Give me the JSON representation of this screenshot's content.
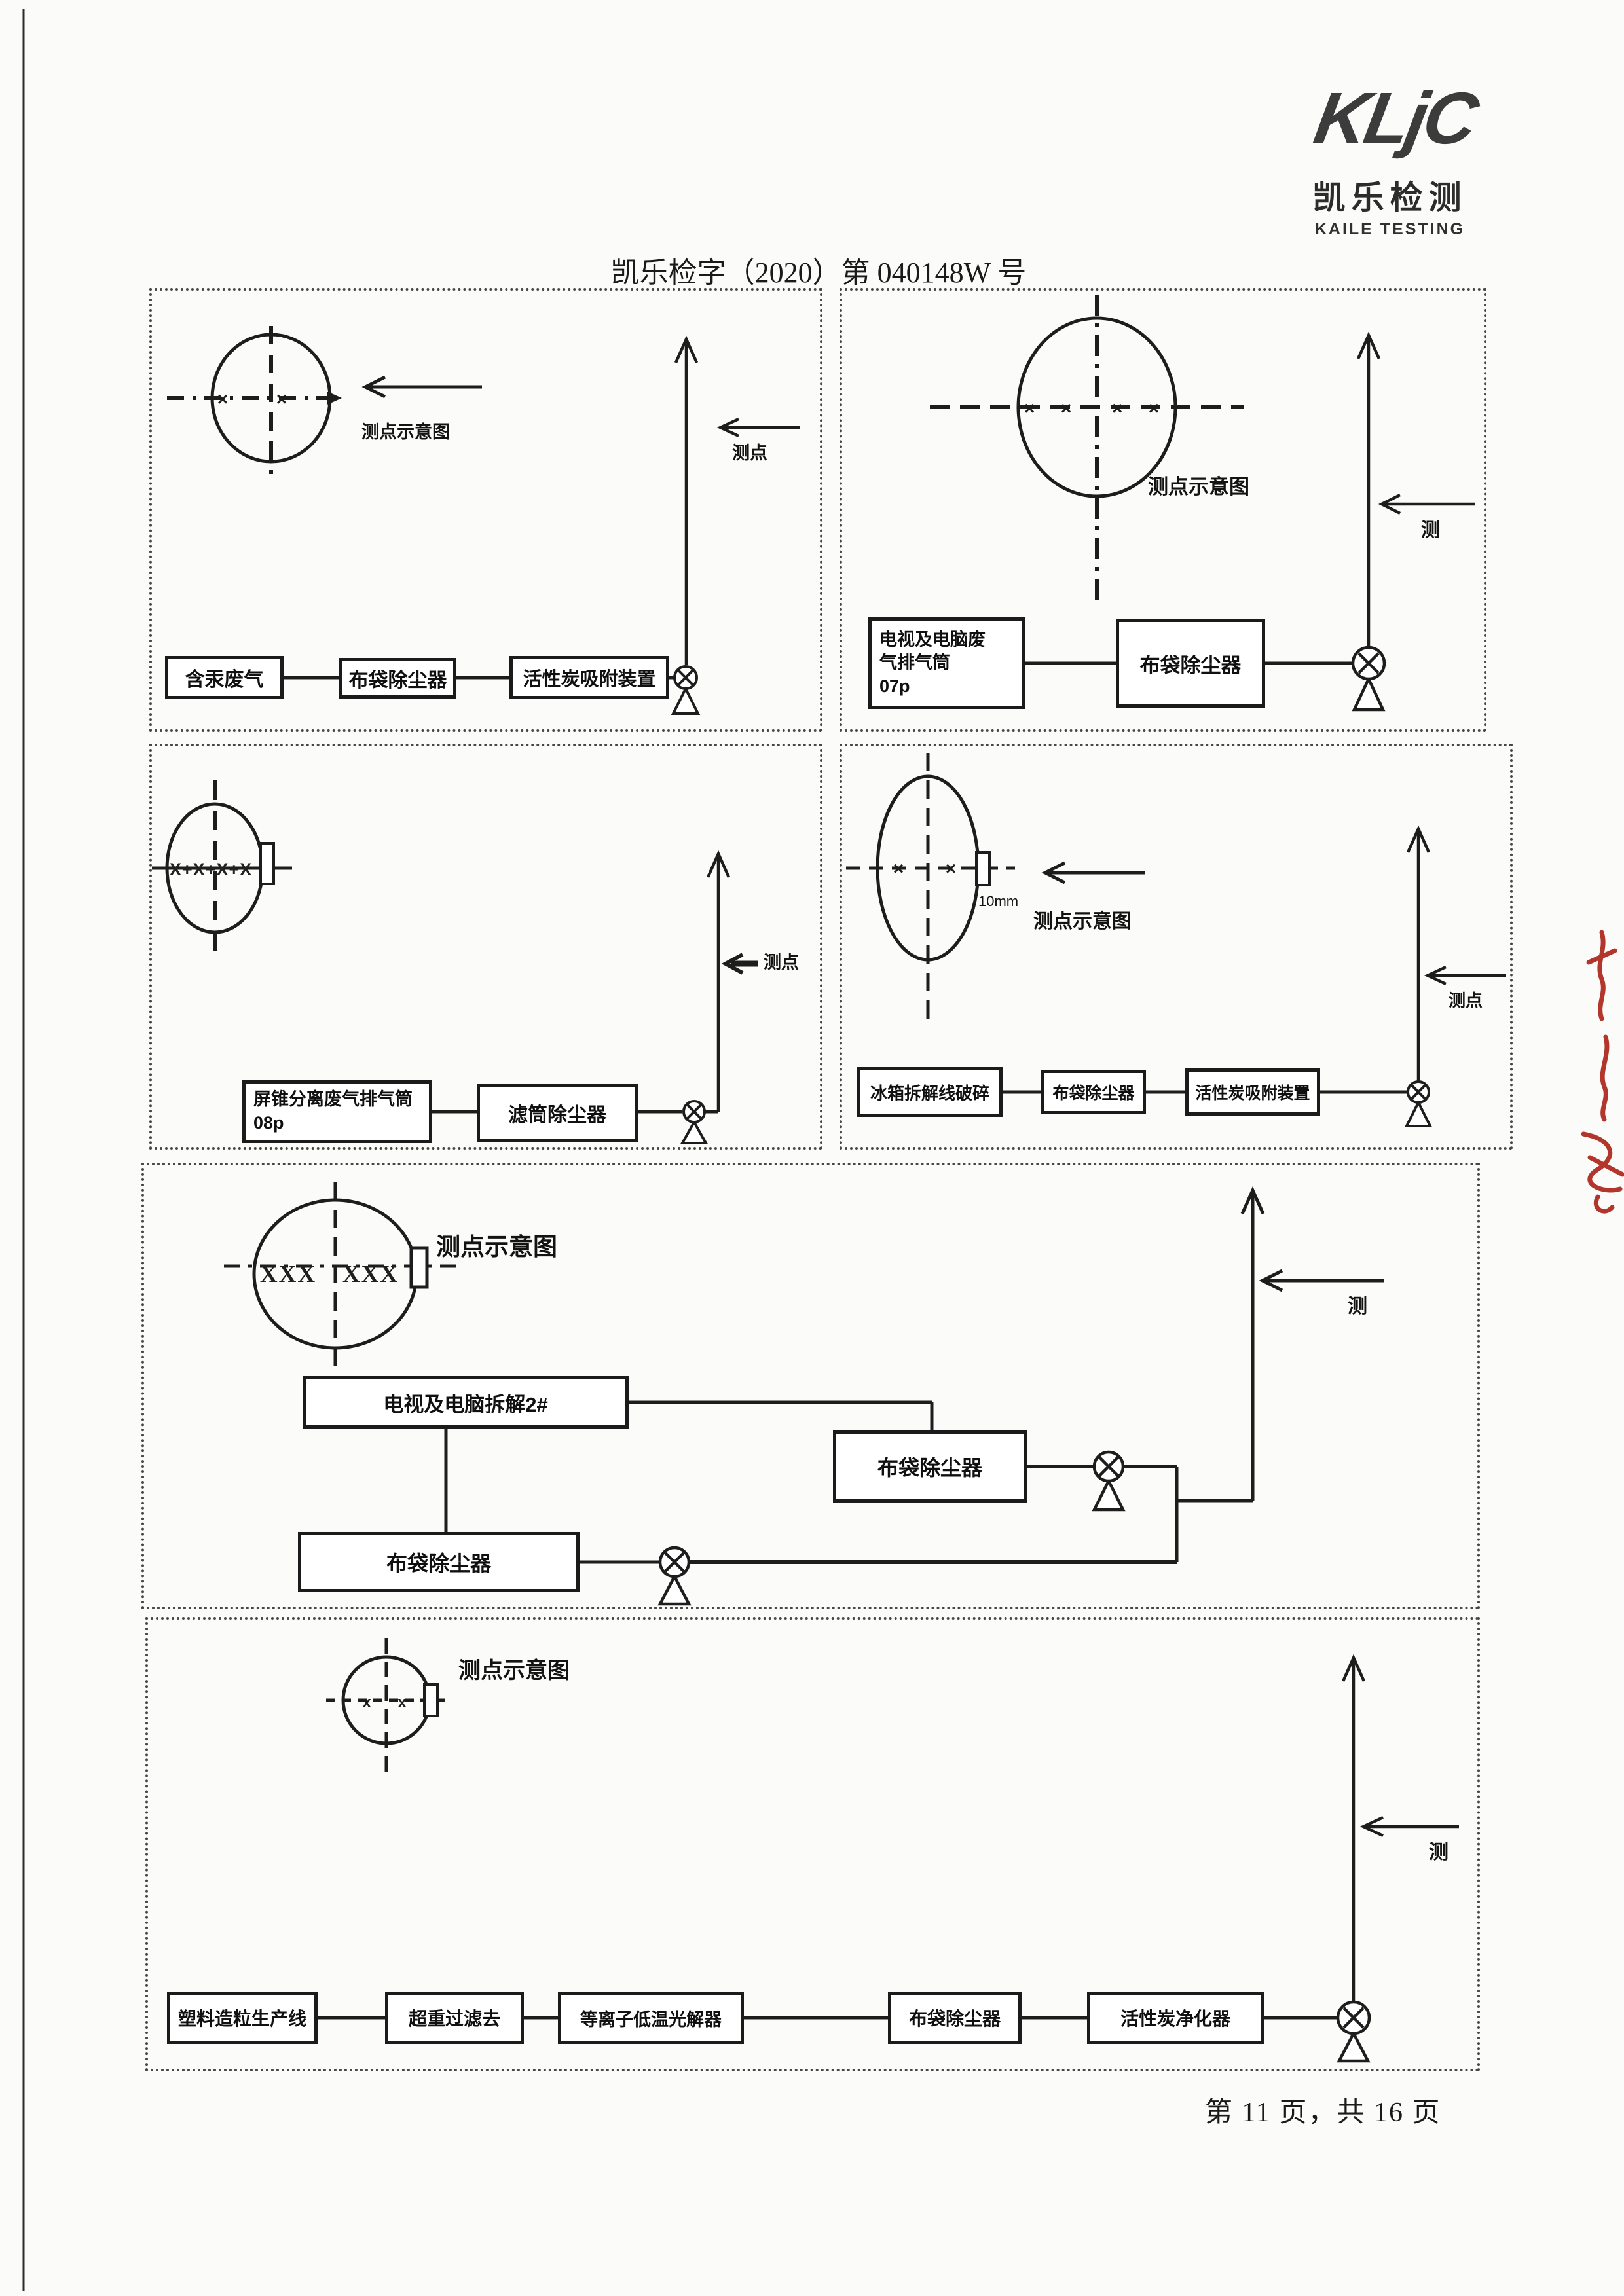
{
  "header": {
    "logo_wordmark": "KLjC",
    "logo_cn": "凯乐检测",
    "logo_en": "KAILE TESTING",
    "doc_number": "凯乐检字（2020）第 040148W 号"
  },
  "footer": {
    "page_info": "第 11 页，共 16 页"
  },
  "panels": {
    "p1": {
      "schematic_label": "测点示意图",
      "point_label": "测点",
      "duct_marks_left": "×",
      "duct_marks_right": "×",
      "boxes": [
        "含汞废气",
        "布袋除尘器",
        "活性炭吸附装置"
      ]
    },
    "p2": {
      "schematic_label": "测点示意图",
      "point_label": "测",
      "marks": [
        "×",
        "×",
        "×",
        "×"
      ],
      "boxes": [
        "电视及电脑废\n气排气筒\n07p",
        "布袋除尘器"
      ]
    },
    "p3": {
      "point_label": "测点",
      "duct_marks": "X+X+X+X",
      "boxes": [
        "屏锥分离废气排气筒\n08p",
        "滤筒除尘器"
      ]
    },
    "p4": {
      "schematic_label": "测点示意图",
      "point_label": "测点",
      "tab_size_label": "10mm",
      "marks": [
        "×",
        "×"
      ],
      "boxes": [
        "冰箱拆解线破碎",
        "布袋除尘器",
        "活性炭吸附装置"
      ]
    },
    "p5": {
      "schematic_label": "测点示意图",
      "point_label": "测",
      "duct_marks_left": "XXX",
      "duct_marks_right": "XXX",
      "boxes": [
        "电视及电脑拆解2#",
        "布袋除尘器",
        "布袋除尘器"
      ]
    },
    "p6": {
      "schematic_label": "测点示意图",
      "point_label": "测",
      "marks": [
        "x",
        "x"
      ],
      "boxes": [
        "塑料造粒生产线",
        "超重过滤去",
        "等离子低温光解器",
        "布袋除尘器",
        "活性炭净化器"
      ]
    }
  }
}
